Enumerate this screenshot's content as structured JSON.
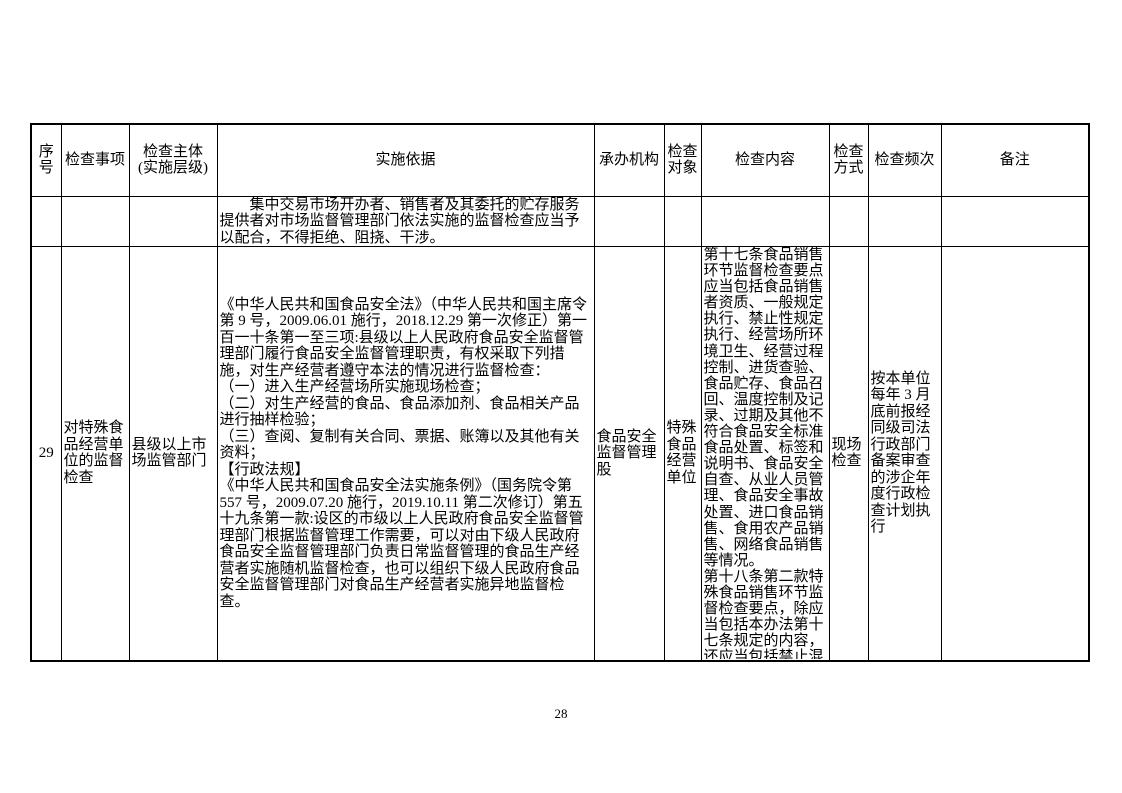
{
  "page_number": "28",
  "table": {
    "header": {
      "seq": "序号",
      "item": "检查事项",
      "subject": "检查主体\n(实施层级)",
      "basis": "实施依据",
      "agency": "承办机构",
      "target": "检查对象",
      "content": "检查内容",
      "method": "检查方式",
      "frequency": "检查频次",
      "remark": "备注"
    },
    "rows": [
      {
        "seq": "",
        "item": "",
        "subject": "",
        "basis": "　　集中交易市场开办者、销售者及其委托的贮存服务提供者对市场监督管理部门依法实施的监督检查应当予以配合，不得拒绝、阻挠、干涉。",
        "agency": "",
        "target": "",
        "content": "",
        "method": "",
        "frequency": "",
        "remark": ""
      },
      {
        "seq": "29",
        "item": "对特殊食品经营单位的监督检查",
        "subject": "县级以上市场监管部门",
        "basis": "《中华人民共和国食品安全法》（中华人民共和国主席令第 9 号，2009.06.01 施行，2018.12.29 第一次修正）第一百一十条第一至三项:县级以上人民政府食品安全监督管理部门履行食品安全监督管理职责，有权采取下列措施，对生产经营者遵守本法的情况进行监督检查：\n（一）进入生产经营场所实施现场检查；\n（二）对生产经营的食品、食品添加剂、食品相关产品进行抽样检验；\n（三）查阅、复制有关合同、票据、账簿以及其他有关资料；\n【行政法规】\n《中华人民共和国食品安全法实施条例》（国务院令第 557 号，2009.07.20 施行，2019.10.11 第二次修订）第五十九条第一款:设区的市级以上人民政府食品安全监督管理部门根据监督管理工作需要，可以对由下级人民政府食品安全监督管理部门负责日常监督管理的食品生产经营者实施随机监督检查，也可以组织下级人民政府食品安全监督管理部门对食品生产经营者实施异地监督检查。",
        "agency": "食品安全监督管理股",
        "target": "特殊食品经营单位",
        "content": "第十七条食品销售环节监督检查要点应当包括食品销售者资质、一般规定执行、禁止性规定执行、经营场所环境卫生、经营过程控制、进货查验、食品贮存、食品召回、温度控制及记录、过期及其他不符合食品安全标准食品处置、标签和说明书、食品安全自查、从业人员管理、食品安全事故处置、进口食品销售、食用农产品销售、网络食品销售等情况。\n第十八条第二款特殊食品销售环节监督检查要点，除应当包括本办法第十七条规定的内容，还应当包括禁止混",
        "method": "现场检查",
        "frequency": "按本单位每年 3 月底前报经同级司法行政部门备案审查的涉企年度行政检查计划执行",
        "remark": ""
      }
    ]
  }
}
